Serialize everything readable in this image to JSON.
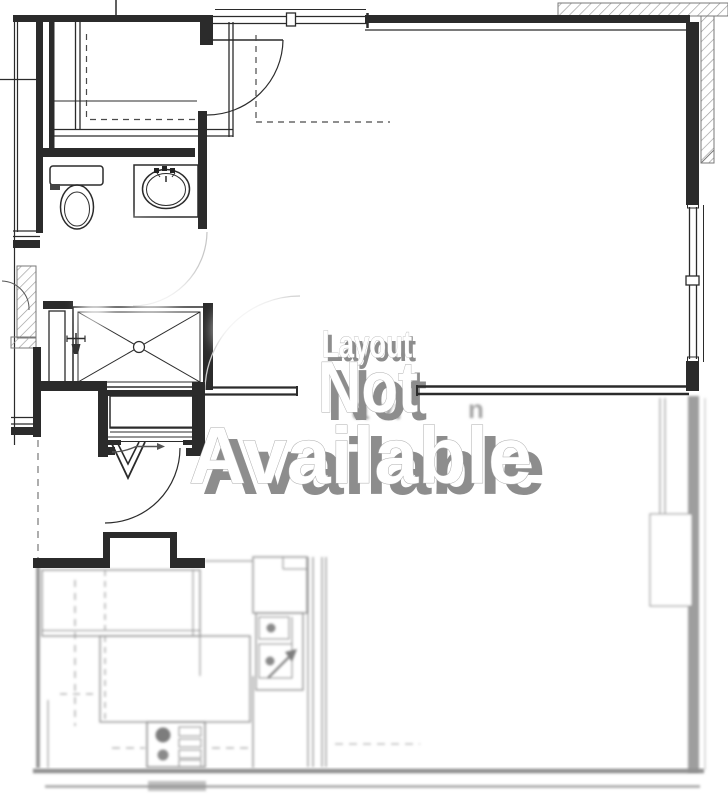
{
  "page": {
    "background": "#ffffff"
  },
  "watermark": {
    "line1": "Layout",
    "line2": "Not",
    "line3": "Available",
    "text_color": "#ffffff",
    "shadow_color": "#8d8d8d",
    "outline_color": "#ababab"
  },
  "underlying_label": {
    "fragment_left": "a vi",
    "fragment_right": "n",
    "color": "#9c9c9c"
  },
  "plan": {
    "ink_color": "#2b2b2b",
    "blurred_ink_color": "#8e8e8e",
    "hatch_color": "#9a9a9a",
    "fixtures": [
      "walk-in-closet",
      "toilet",
      "vanity-sink",
      "shower",
      "entry-door",
      "interior-doors",
      "windows",
      "refrigerator",
      "kitchen-sink",
      "range",
      "cabinets"
    ]
  }
}
